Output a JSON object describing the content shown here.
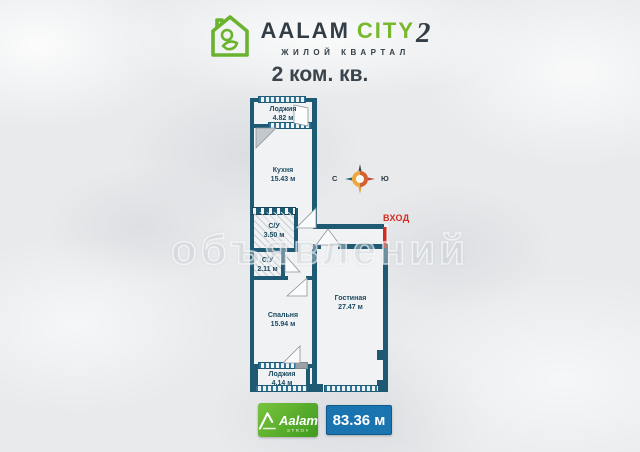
{
  "header": {
    "brand_name": "AALAM",
    "brand_city": "CITY",
    "brand_number": "2",
    "brand_subtitle": "ЖИЛОЙ КВАРТАЛ",
    "title": "2 ком. кв."
  },
  "plan": {
    "rooms": [
      {
        "name": "Лоджия",
        "area": "4.82 м"
      },
      {
        "name": "Кухня",
        "area": "15.43 м"
      },
      {
        "name": "С/У",
        "area": "3.50 м"
      },
      {
        "name": "С/У",
        "area": "2.11 м"
      },
      {
        "name": "Спальня",
        "area": "15.94 м"
      },
      {
        "name": "Лоджия",
        "area": "4.14 м"
      },
      {
        "name": "Гостиная",
        "area": "27.47 м"
      }
    ],
    "entrance_label": "ВХОД",
    "compass": {
      "left": "С",
      "right": "Ю"
    }
  },
  "watermark": "объявлений",
  "footer": {
    "builder_name": "Aalam",
    "builder_sub": "STROY",
    "total_area": "83.36 м"
  },
  "colors": {
    "wall": "#1e5a74",
    "brand_green": "#78b82d",
    "badge_blue": "#1a74b0",
    "entrance_red": "#d42b1f"
  }
}
